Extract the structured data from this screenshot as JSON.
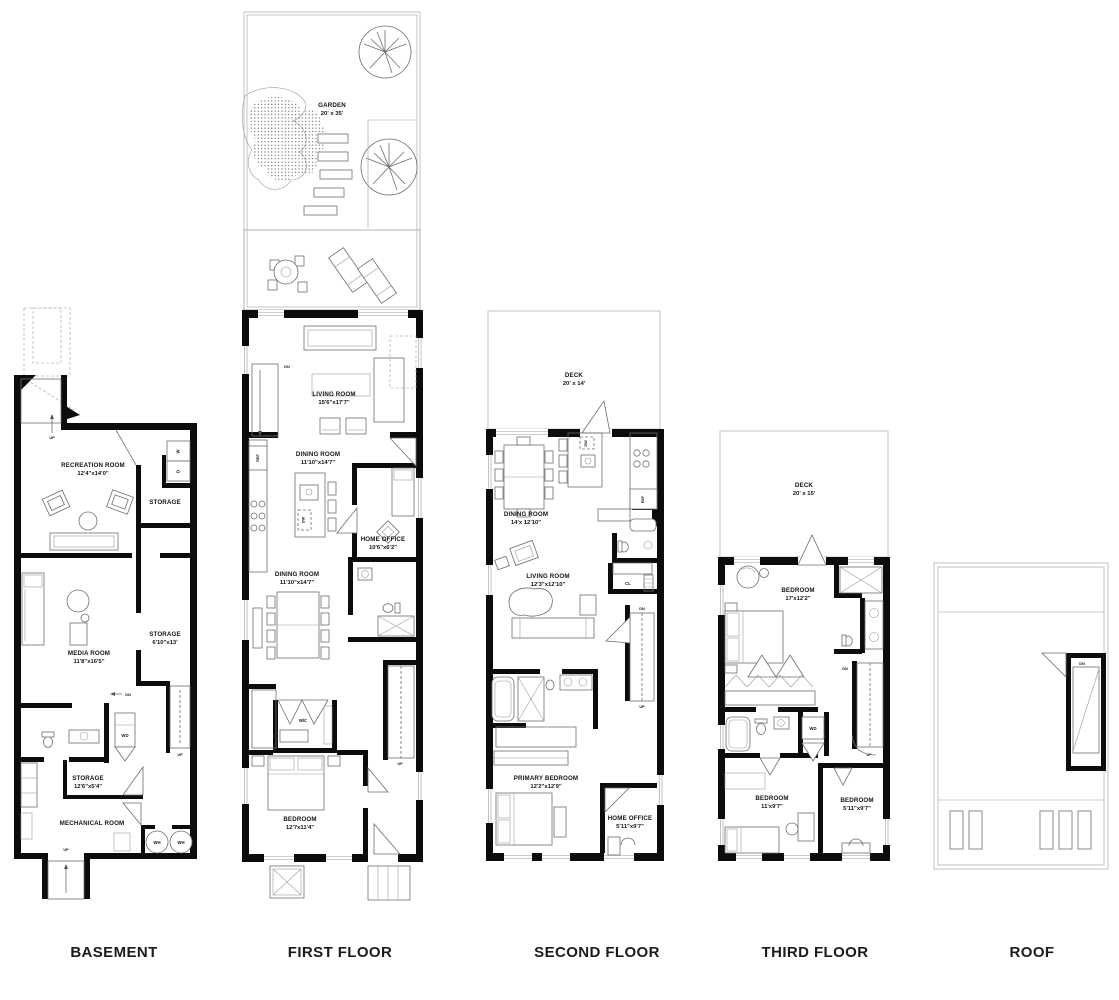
{
  "titles": {
    "basement": "BASEMENT",
    "first": "FIRST FLOOR",
    "second": "SECOND FLOOR",
    "third": "THIRD FLOOR",
    "roof": "ROOF"
  },
  "ann": {
    "up": "UP",
    "dn": "DN",
    "wd": "WD",
    "wh": "WH",
    "w": "W",
    "d": "D",
    "ref": "REF",
    "dw": "DW",
    "cl": "CL",
    "wc": "W/C"
  },
  "basement": {
    "recreation": {
      "name": "RECREATION ROOM",
      "dims": "12'4\"x14'0\""
    },
    "storage_upper": {
      "name": "STORAGE"
    },
    "media": {
      "name": "MEDIA ROOM",
      "dims": "11'8\"x16'5\""
    },
    "storage_mid": {
      "name": "STORAGE",
      "dims": "6'10\"x13'"
    },
    "storage_lower": {
      "name": "STORAGE",
      "dims": "12'6\"x5'4\""
    },
    "mechanical": {
      "name": "MECHANICAL ROOM"
    }
  },
  "first": {
    "garden": {
      "name": "GARDEN",
      "dims": "20' x 35'"
    },
    "living": {
      "name": "LIVING ROOM",
      "dims": "15'6\"x17'7\""
    },
    "dining_upper": {
      "name": "DINING ROOM",
      "dims": "11'10\"x14'7\""
    },
    "home_office": {
      "name": "HOME OFFICE",
      "dims": "10'6\"x6'2\""
    },
    "dining_lower": {
      "name": "DINING ROOM",
      "dims": "11'10\"x14'7\""
    },
    "bedroom": {
      "name": "BEDROOM",
      "dims": "12'7x11'4\""
    }
  },
  "second": {
    "deck": {
      "name": "DECK",
      "dims": "20' x 14'"
    },
    "dining": {
      "name": "DINING ROOM",
      "dims": "14'x 12'10\""
    },
    "living": {
      "name": "LIVING ROOM",
      "dims": "12'3\"x12'10\""
    },
    "primary": {
      "name": "PRIMARY BEDROOM",
      "dims": "12'2\"x12'9\""
    },
    "home_office": {
      "name": "HOME OFFICE",
      "dims": "5'11\"x9'7\""
    }
  },
  "third": {
    "deck": {
      "name": "DECK",
      "dims": "20' x 15'"
    },
    "bedroom_large": {
      "name": "BEDROOM",
      "dims": "17'x12'2\""
    },
    "bedroom_mid": {
      "name": "BEDROOM",
      "dims": "11'x9'7\""
    },
    "bedroom_small": {
      "name": "BEDROOM",
      "dims": "5'11\"x9'7\""
    }
  }
}
